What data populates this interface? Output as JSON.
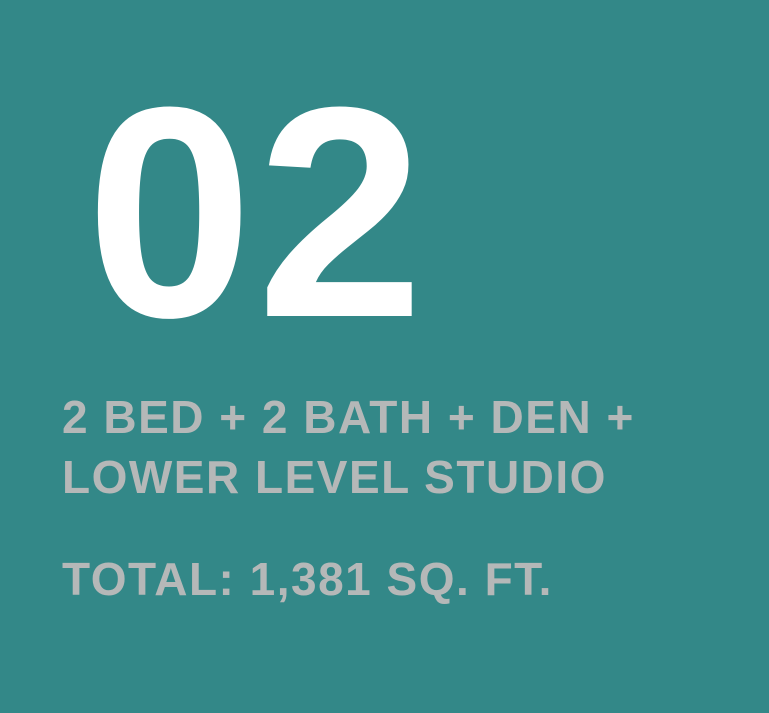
{
  "card": {
    "unit_number": "02",
    "description_line1": "2 BED + 2 BATH + DEN +",
    "description_line2": "LOWER LEVEL STUDIO",
    "total_area": "TOTAL: 1,381 SQ. FT.",
    "colors": {
      "background": "#338888",
      "number": "#ffffff",
      "text": "#b5b8b8"
    }
  }
}
